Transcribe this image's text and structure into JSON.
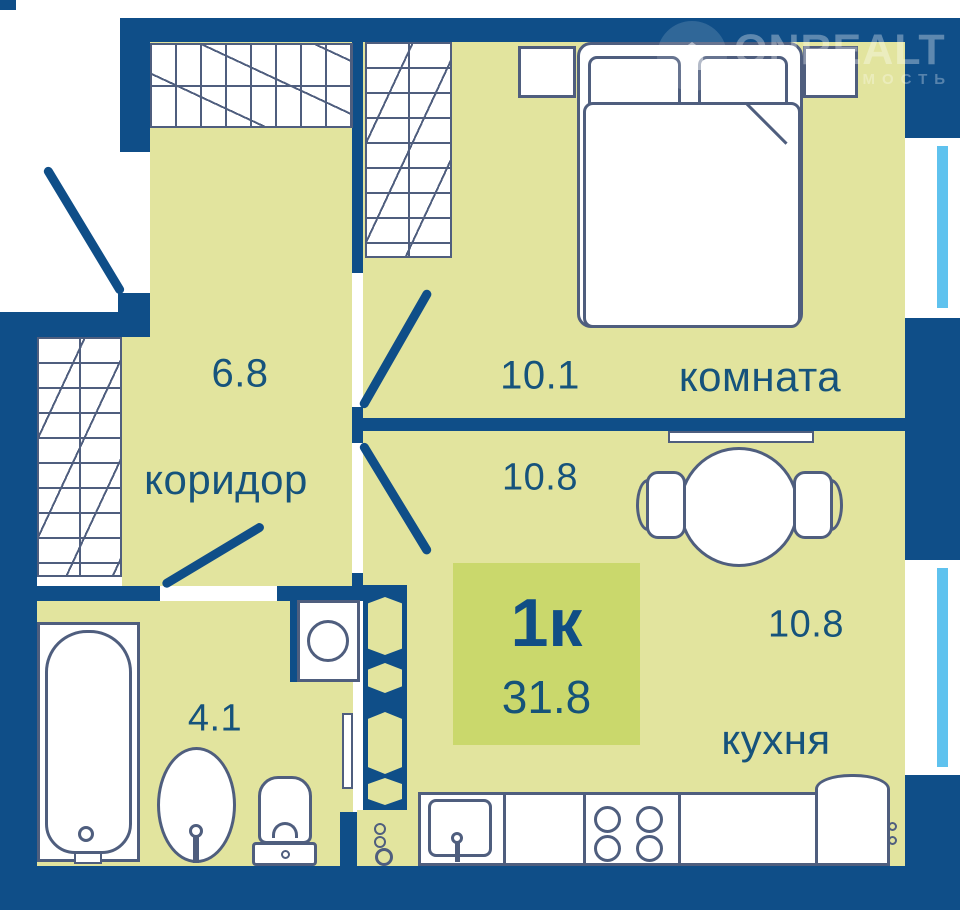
{
  "watermark": {
    "brand": "ONREALT",
    "tagline": "НЕДВИЖИМОСТЬ"
  },
  "badge": {
    "rooms": "1к",
    "total_area": "31.8"
  },
  "rooms": {
    "hall": {
      "name": "коридор",
      "area": "6.8"
    },
    "bedroom": {
      "name": "комната",
      "area": "10.1"
    },
    "kitchen": {
      "name": "кухня",
      "area_top": "10.8",
      "area_bottom": "10.8"
    },
    "bathroom": {
      "area": "4.1"
    }
  },
  "colors": {
    "wall": "#0f4e88",
    "floor": "#e2e49e",
    "badge": "#cad86c",
    "furniture_outline": "#4f5e7e",
    "window_glass": "#5fc2ee",
    "label_text": "#16537c"
  }
}
